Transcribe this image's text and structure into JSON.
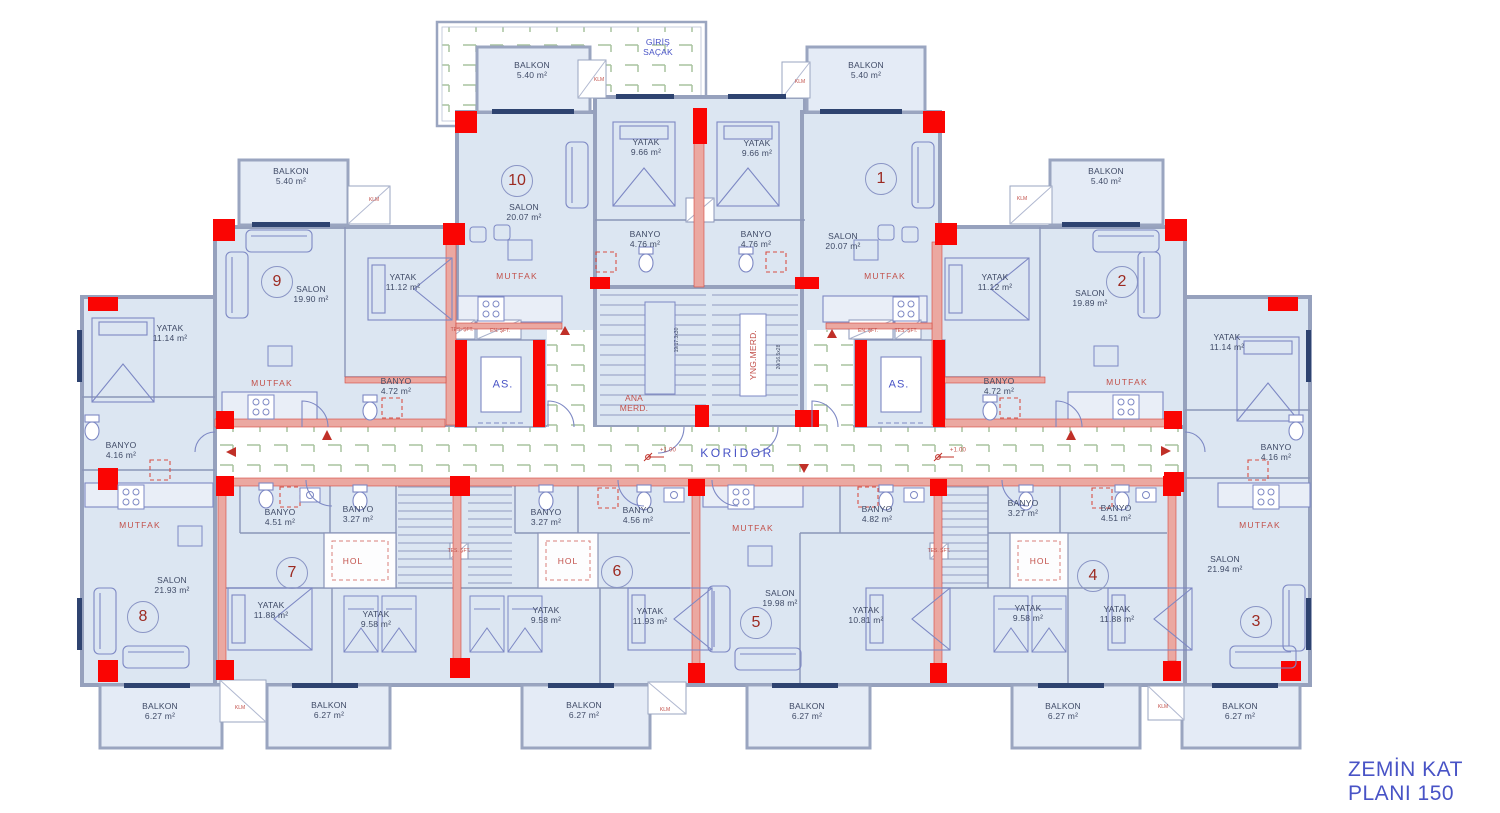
{
  "plan": {
    "title_line1": "ZEMİN KAT",
    "title_line2": "PLANI 150",
    "corridor": "KORİDOR",
    "entrance_1": "GİRİŞ",
    "entrance_2": "SAÇAK",
    "elevator": "AS.",
    "main_stair_1": "ANA",
    "main_stair_2": "MERD.",
    "fire_stair": "YNG.MERD.",
    "main_stair_dim": "19/17.3x30",
    "fire_stair_dim": "20/16.5x28",
    "level": "+1.00",
    "ac": "KLM",
    "shaft_1": "TES. ŞFT.",
    "shaft_2": "EN. ŞFT."
  },
  "units": {
    "u1": "1",
    "u2": "2",
    "u3": "3",
    "u4": "4",
    "u5": "5",
    "u6": "6",
    "u7": "7",
    "u8": "8",
    "u9": "9",
    "u10": "10"
  },
  "rooms": {
    "b540": {
      "name": "BALKON",
      "area": "5.40 m²"
    },
    "b627": {
      "name": "BALKON",
      "area": "6.27 m²"
    },
    "y966": {
      "name": "YATAK",
      "area": "9.66 m²"
    },
    "y1112": {
      "name": "YATAK",
      "area": "11.12 m²"
    },
    "y1114": {
      "name": "YATAK",
      "area": "11.14 m²"
    },
    "y958": {
      "name": "YATAK",
      "area": "9.58 m²"
    },
    "y1188": {
      "name": "YATAK",
      "area": "11.88 m²"
    },
    "y1193": {
      "name": "YATAK",
      "area": "11.93 m²"
    },
    "y1081": {
      "name": "YATAK",
      "area": "10.81 m²"
    },
    "bn476": {
      "name": "BANYO",
      "area": "4.76 m²"
    },
    "bn472": {
      "name": "BANYO",
      "area": "4.72 m²"
    },
    "bn416": {
      "name": "BANYO",
      "area": "4.16 m²"
    },
    "bn451": {
      "name": "BANYO",
      "area": "4.51 m²"
    },
    "bn327": {
      "name": "BANYO",
      "area": "3.27 m²"
    },
    "bn456": {
      "name": "BANYO",
      "area": "4.56 m²"
    },
    "bn482": {
      "name": "BANYO",
      "area": "4.82 m²"
    },
    "s2007": {
      "name": "SALON",
      "area": "20.07 m²"
    },
    "s1990": {
      "name": "SALON",
      "area": "19.90 m²"
    },
    "s1989": {
      "name": "SALON",
      "area": "19.89 m²"
    },
    "s2193": {
      "name": "SALON",
      "area": "21.93 m²"
    },
    "s2194": {
      "name": "SALON",
      "area": "21.94 m²"
    },
    "s1998": {
      "name": "SALON",
      "area": "19.98 m²"
    },
    "mutfak": "MUTFAK",
    "hol": "HOL"
  },
  "colors": {
    "room_fill": "#dce6f2",
    "wall_gray": "#96a1bd",
    "wall_pink": "#eba8a1",
    "column_red": "#fa0503",
    "hatch_green": "#a9c49f",
    "label_blue": "#4853c6",
    "label_red": "#c2504a"
  }
}
